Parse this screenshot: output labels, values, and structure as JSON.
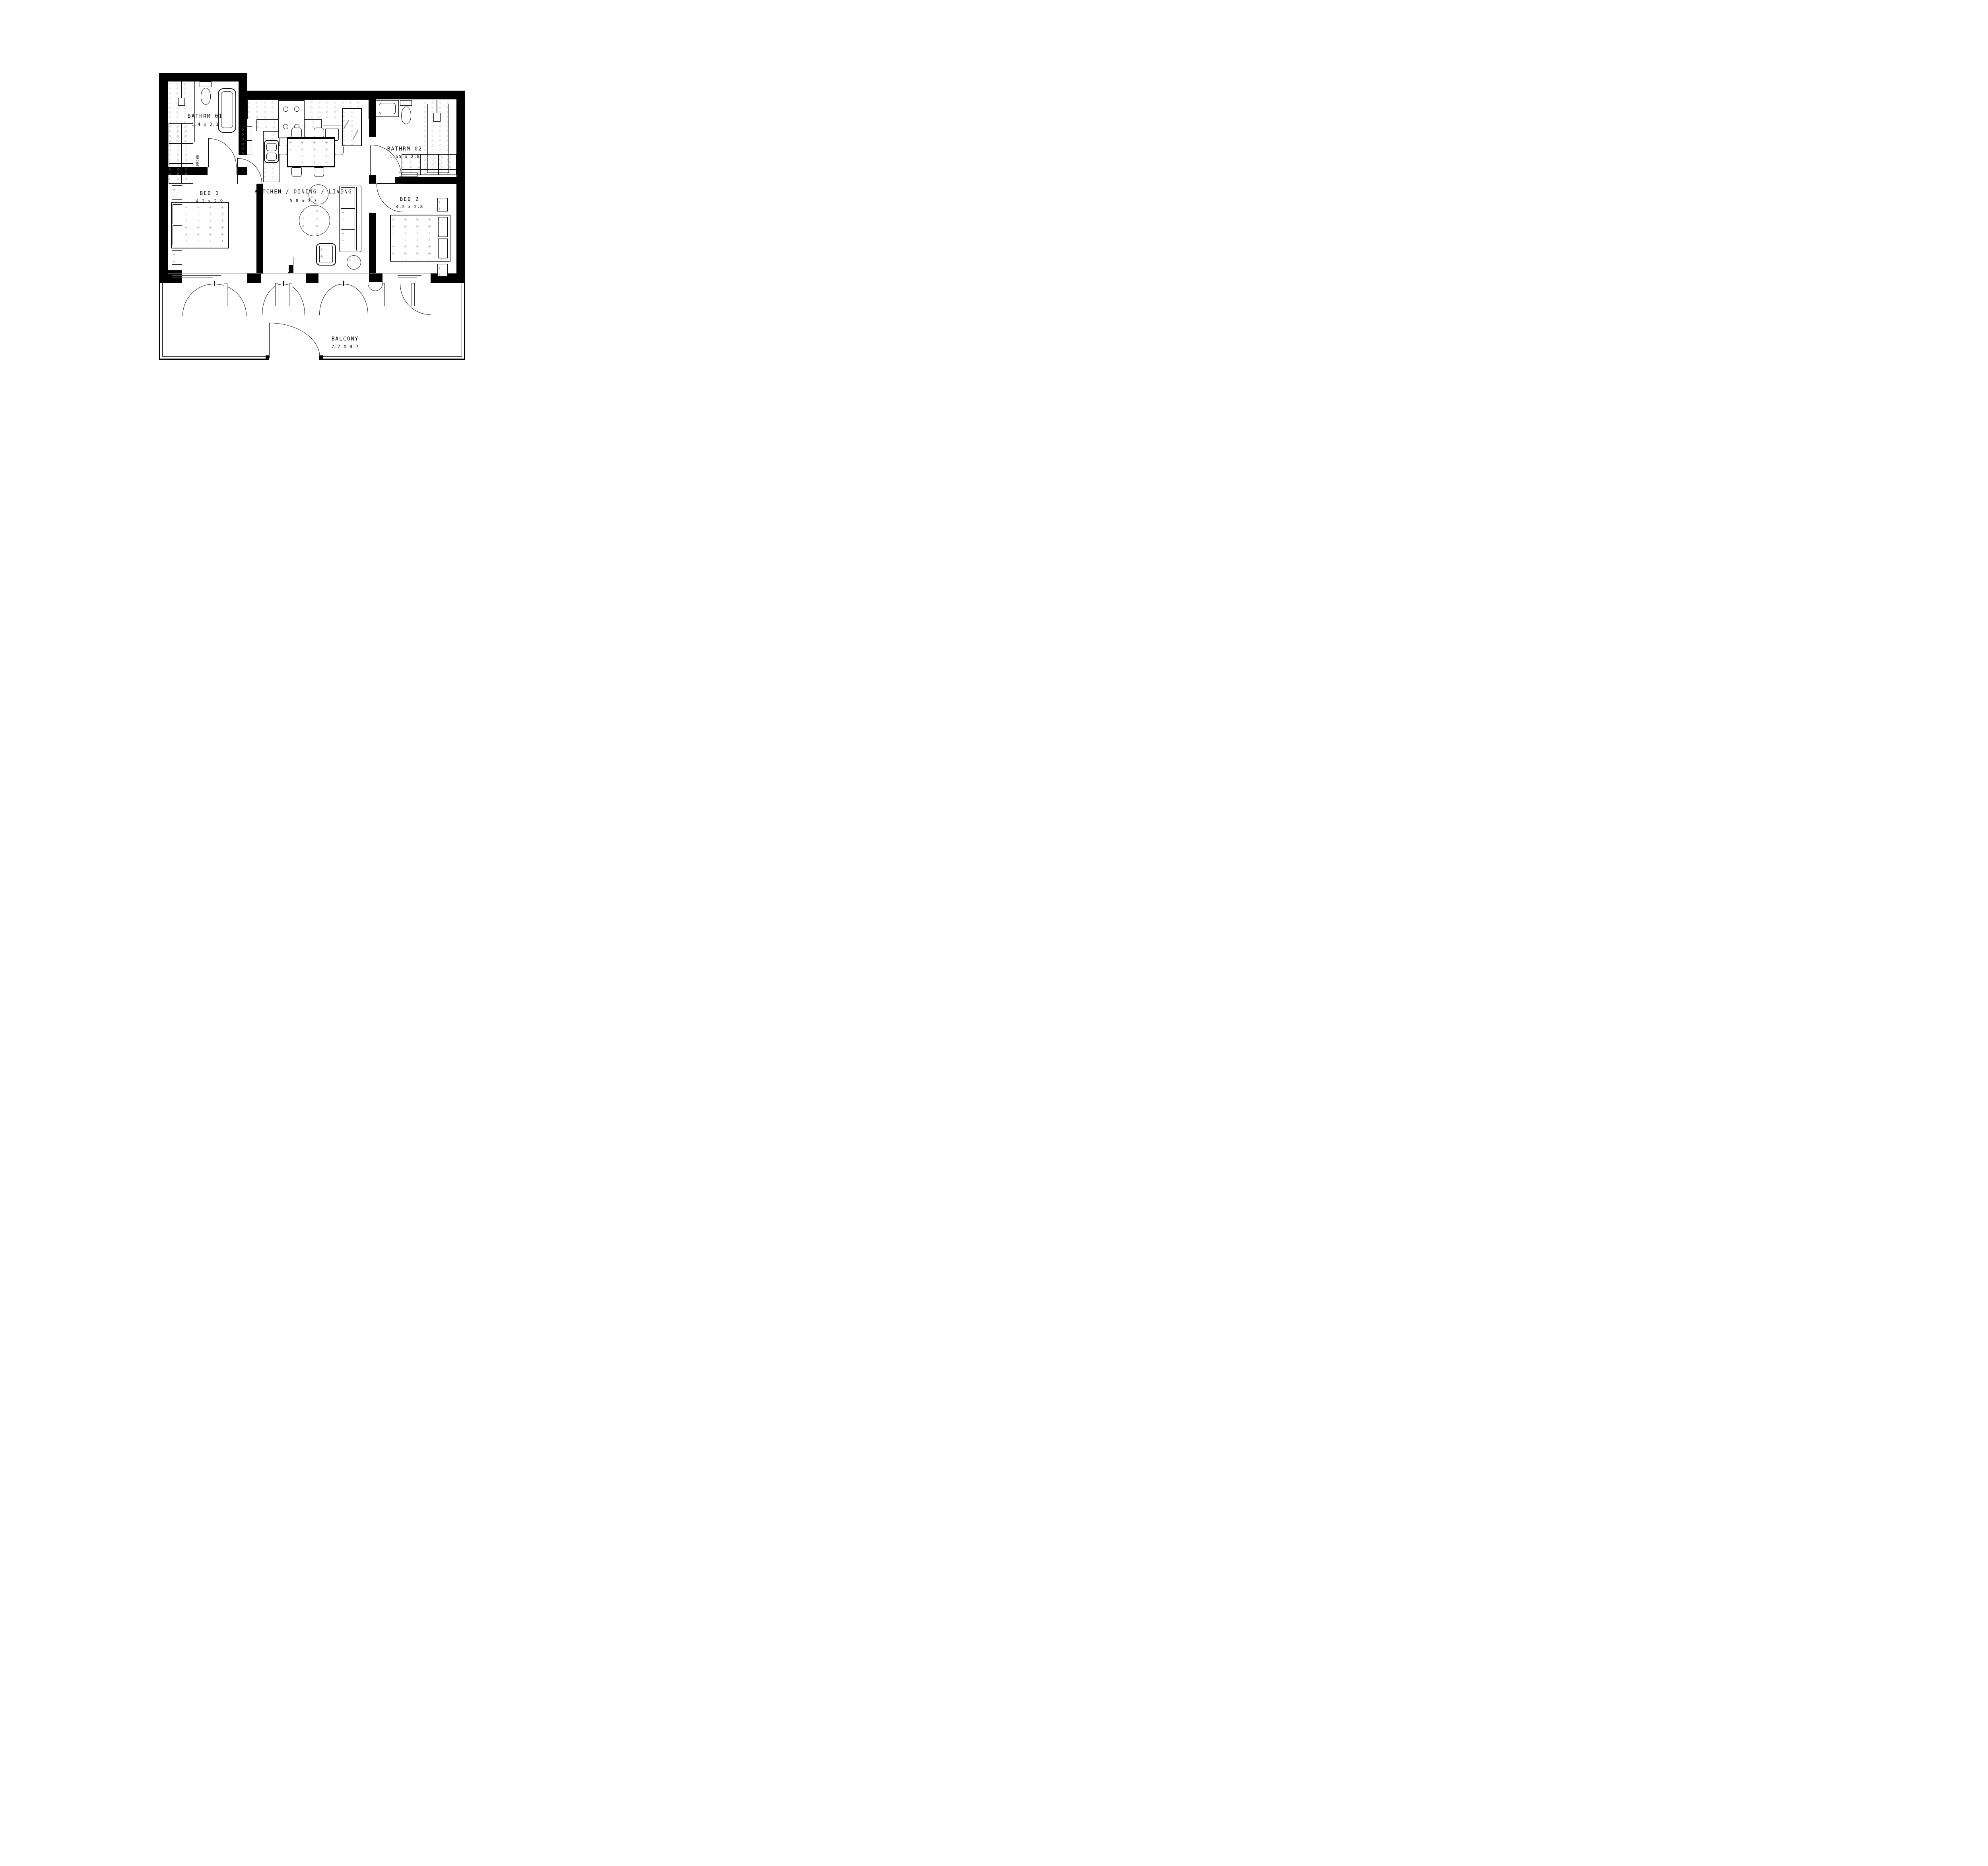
{
  "plan_title": "Two-bed apartment floor plan",
  "rooms": [
    {
      "id": "bathrm01",
      "name": "BATHRM 01",
      "dims": "1.4 x 2.3"
    },
    {
      "id": "bathrm02",
      "name": "BATHRM 02",
      "dims": "1.55 x 2.8"
    },
    {
      "id": "bed1",
      "name": "BED 1",
      "dims": "4.2 x 2.9"
    },
    {
      "id": "bed2",
      "name": "BED 2",
      "dims": "4.2 x 2.8"
    },
    {
      "id": "kitchen",
      "name": "KITCHEN / DINING / LIVING",
      "dims": "5.8 x 3.7"
    },
    {
      "id": "balcony",
      "name": "BALCONY",
      "dims": "7.7 X 9.7"
    }
  ],
  "labels": {
    "wardrobe_bed1": "WARDROBE",
    "wardrobe_bed2": "WARDROBE"
  },
  "patterns": {
    "dot": "○",
    "plus": "+",
    "cross": "×"
  },
  "colors": {
    "wall": "#000000",
    "line": "#111111",
    "hatch": "#b2b2b2",
    "sill": "#555555"
  }
}
